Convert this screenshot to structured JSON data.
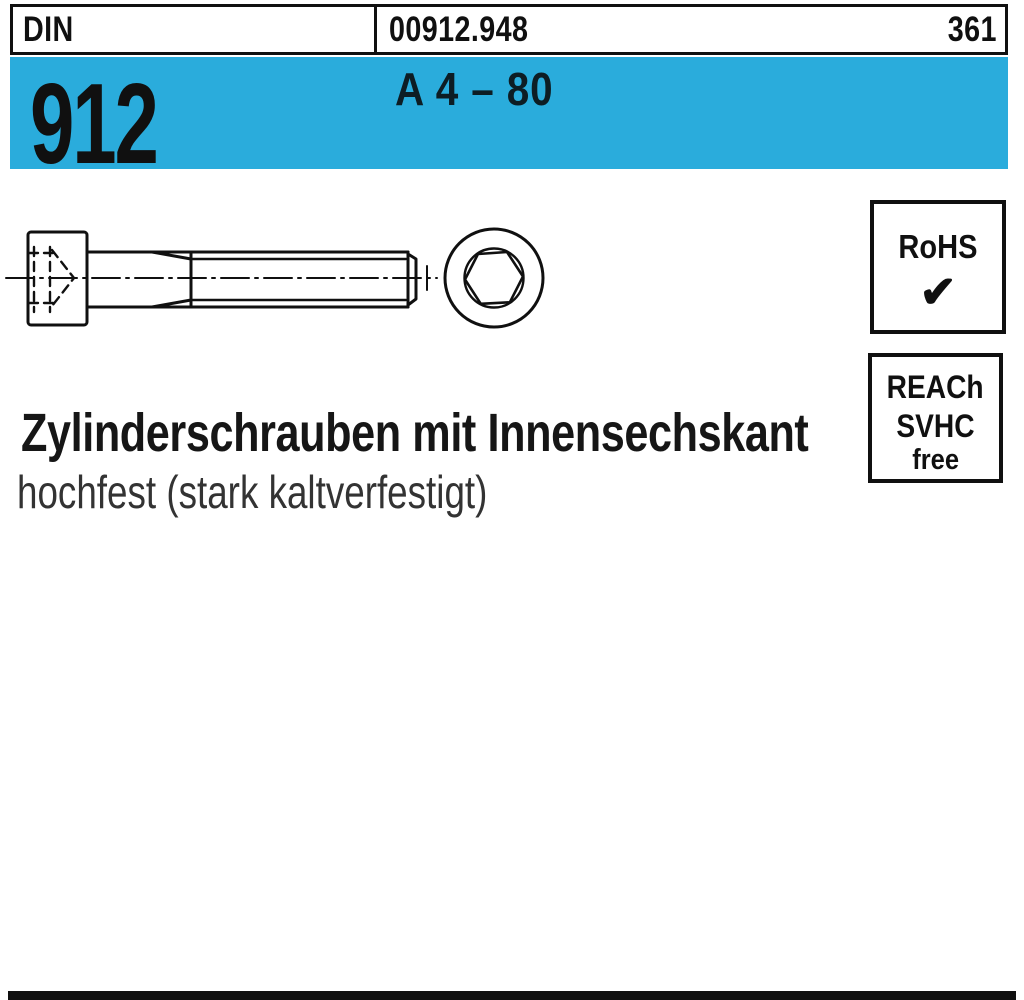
{
  "colors": {
    "banner_blue": "#2aacdc",
    "ink": "#101010",
    "subtitle_gray": "#333333",
    "background": "#ffffff"
  },
  "header": {
    "din_label": "DIN",
    "article_number": "00912.948",
    "page_number": "361"
  },
  "banner": {
    "standard_number": "912",
    "material_grade": "A 4 – 80"
  },
  "badges": {
    "rohs": {
      "label": "RoHS",
      "check_icon": "✔"
    },
    "reach": {
      "line1": "REACh",
      "line2": "SVHC",
      "line3": "free"
    }
  },
  "product": {
    "title": "Zylinderschrauben mit Innensechskant",
    "subtitle": "hochfest (stark kaltverfestigt)"
  }
}
